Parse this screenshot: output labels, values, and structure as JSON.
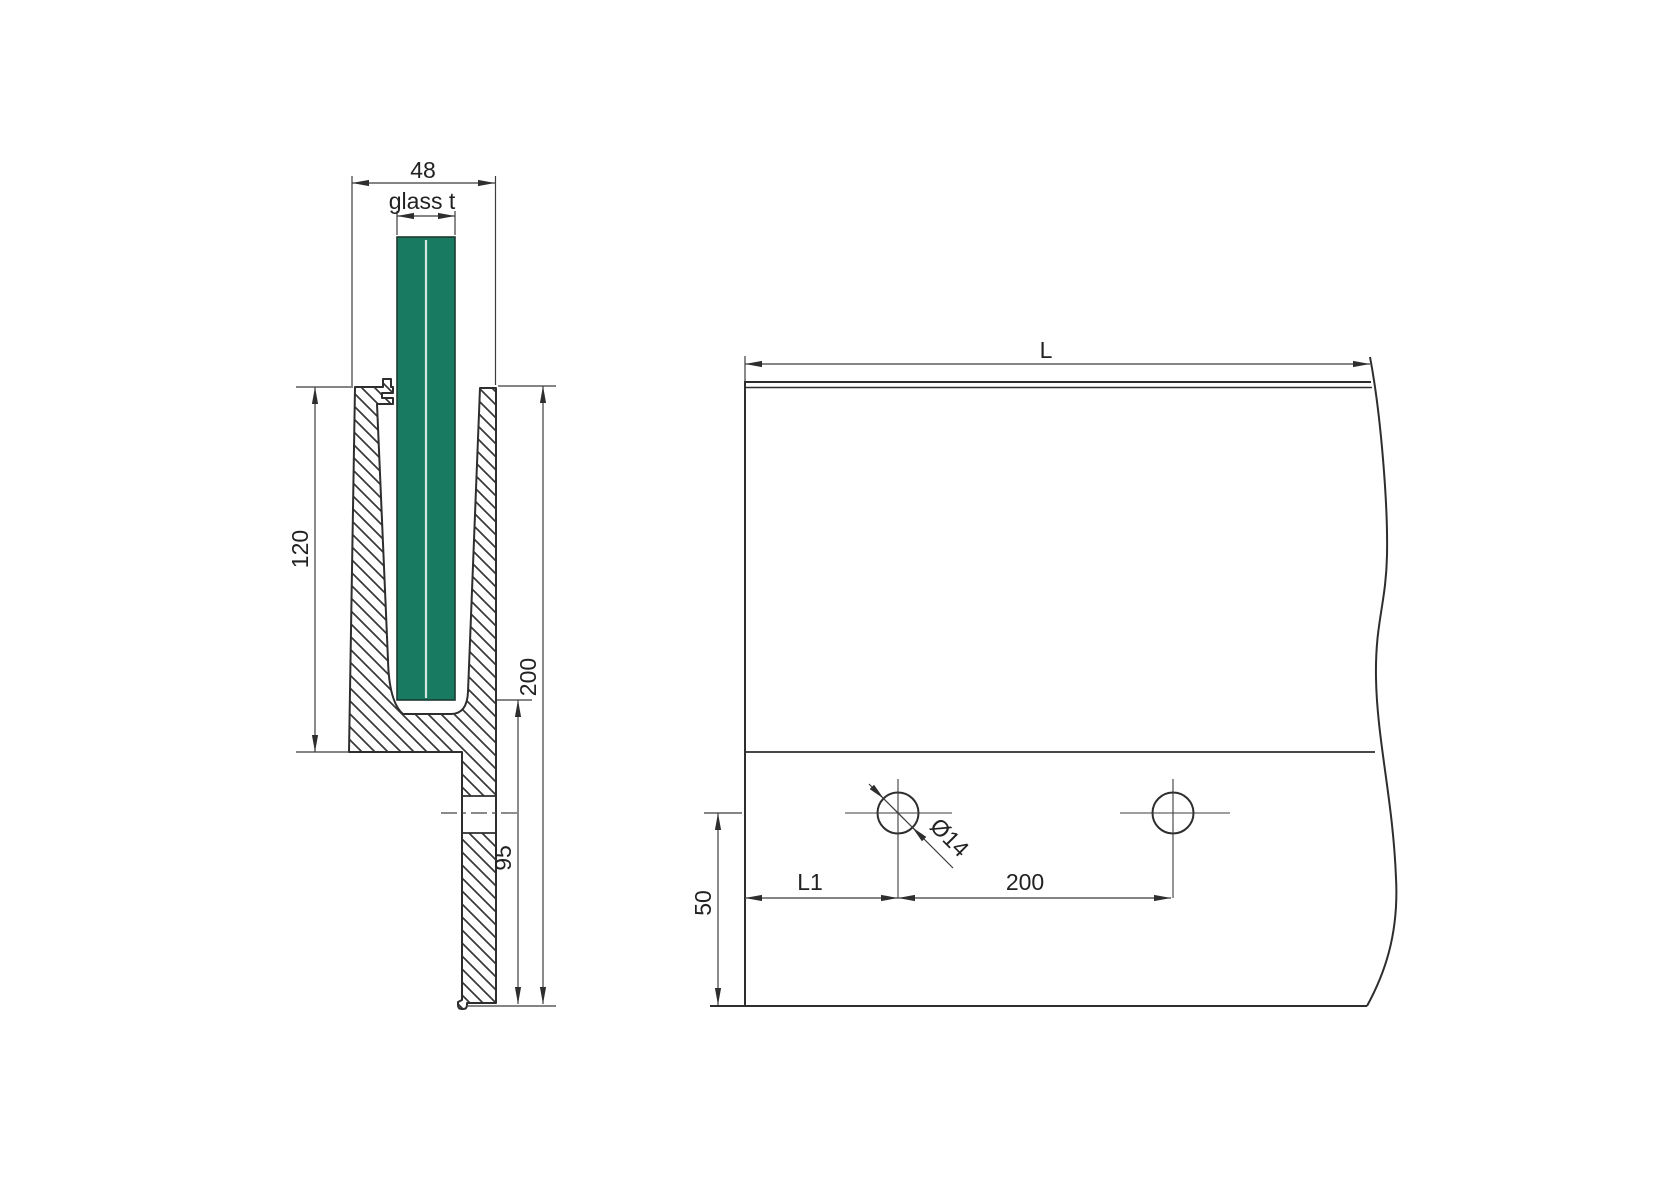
{
  "section": {
    "width": "48",
    "glass_thickness_label": "glass t",
    "channel_depth": "120",
    "total_height": "200",
    "seat_to_bottom": "95"
  },
  "elevation": {
    "length_label": "L",
    "edge_to_first_hole": "L1",
    "hole_spacing": "200",
    "hole_center_to_bottom": "50",
    "hole_diameter": "Ø14"
  },
  "colors": {
    "glass_green": "#177a61",
    "interlayer": "#d2e7de",
    "outline": "#2e2e2e",
    "dimension_line": "#3c3c3c"
  }
}
